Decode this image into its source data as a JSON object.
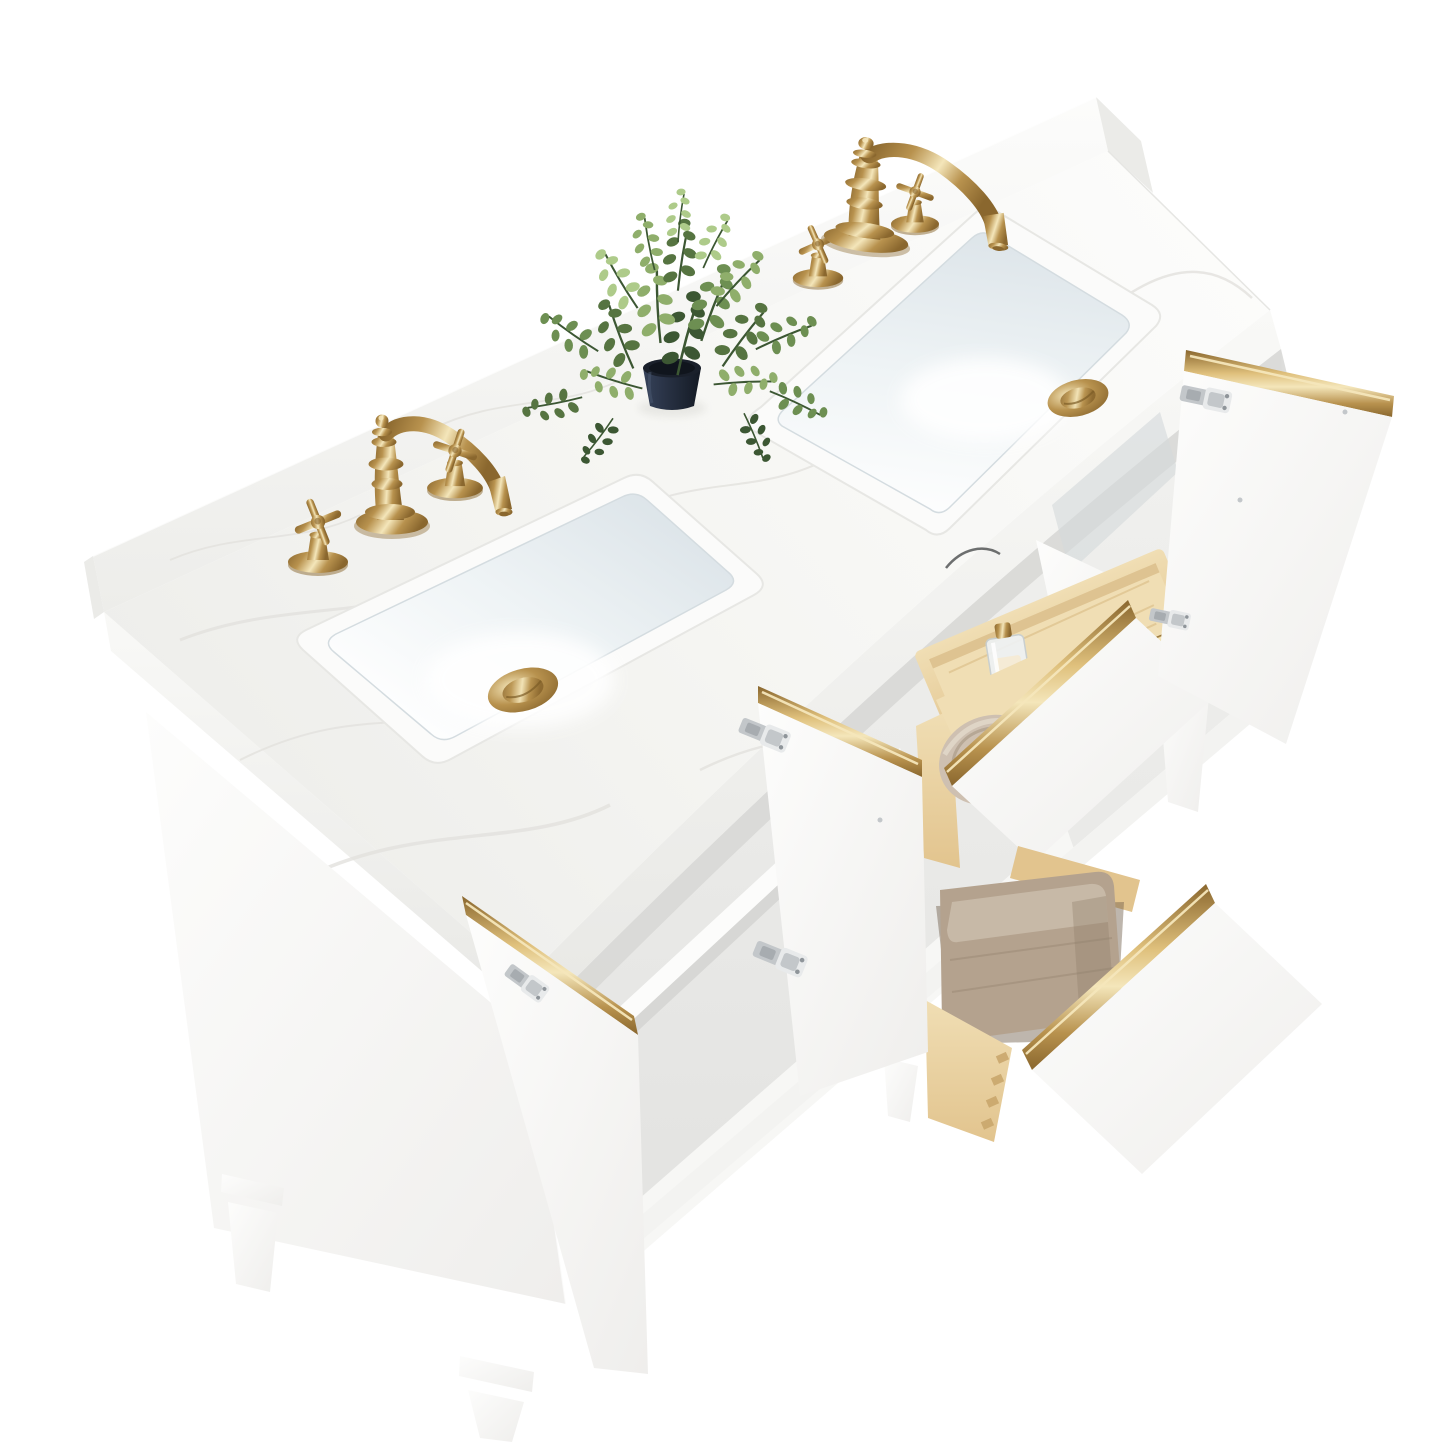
{
  "scene": {
    "type": "product-photo",
    "description": "Overhead three-quarter product photo of a white double-sink bathroom vanity on a plain white background: white marble countertop with backsplash, two rectangular undermount ceramic sinks, two brushed-gold widespread faucets with cross handles and gold pop-up drains, a small faux green plant in a dark pot, a white cabinet with brushed-gold edge trim, open doors with nickel soft-close hinges, a tilt-out pine organizer tray holding a glass perfume bottle and a mascara tube, two pulled-out pine dovetail drawers holding a rolled beige towel and a folded taupe towel, and tapered white legs.",
    "objects": {
      "backsplash": "White marble backsplash",
      "countertop": "White engineered-marble countertop",
      "left_sink": "Rectangular undermount ceramic sink",
      "right_sink": "Rectangular undermount ceramic sink",
      "faucets": "Brushed-gold widespread faucets with cross handles",
      "drains": "Gold pop-up drain caps",
      "plant": "Faux eucalyptus plant in dark navy pot",
      "cabinet": "White vanity cabinet with open storage",
      "left_door": "Open cabinet door with gold edge trim",
      "middle_door": "Open cabinet door with nickel hinges",
      "right_door": "Open cabinet door with gold edge trim",
      "edge_door": "Cabinet door seen edge-on with gold trim",
      "tilt_tray": "Tilt-out pine organizer tray with perfume bottle and mascara",
      "top_drawer": "Open pine drawer with rolled beige towel and gold rail",
      "bottom_drawer": "Open pine dovetail drawer with folded taupe towel and gold rail",
      "legs": "Tapered white wood legs",
      "shelf": "Interior adjustable shelf"
    }
  },
  "colors": {
    "bg": "#ffffff",
    "marble_base": "#f6f6f3",
    "marble_shadow": "#ededea",
    "vein": "#e2e1dd",
    "backsplash_side": "#ebebe8",
    "cab_white": "#fbfbfa",
    "interior_shadow": "#d7d7d5",
    "shelf": "#fcfcfb",
    "rim_line": "#e1e7e9",
    "basin_gray": "#dbe3e8",
    "basin_mid": "#eef3f5",
    "gold_dark": "#8a672e",
    "gold_mid": "#b8924e",
    "gold_light": "#dfc07c",
    "gold_highlight": "#f4e6ba",
    "pine_light": "#f0deb4",
    "pine_mid": "#e2c48e",
    "pine_grain": "#c7a265",
    "towel_roll": "#cec0b1",
    "towel_roll_dark": "#a3927d",
    "towel_fold": "#b4a28e",
    "towel_fold_light": "#c9bbaa",
    "towel_fold_dark": "#8e7d69",
    "pot_dark": "#1d2530",
    "leaf_dark": "#3c5733",
    "leaf_mid": "#567441",
    "leaf": "#6d8f52",
    "leaf_light": "#8fae6b",
    "leaf_pale": "#aecb8a",
    "hinge_light": "#e8eaeb",
    "hinge_mid": "#c3c7ca",
    "hinge_dark": "#8f959a",
    "wire": "#4a4c4e"
  }
}
